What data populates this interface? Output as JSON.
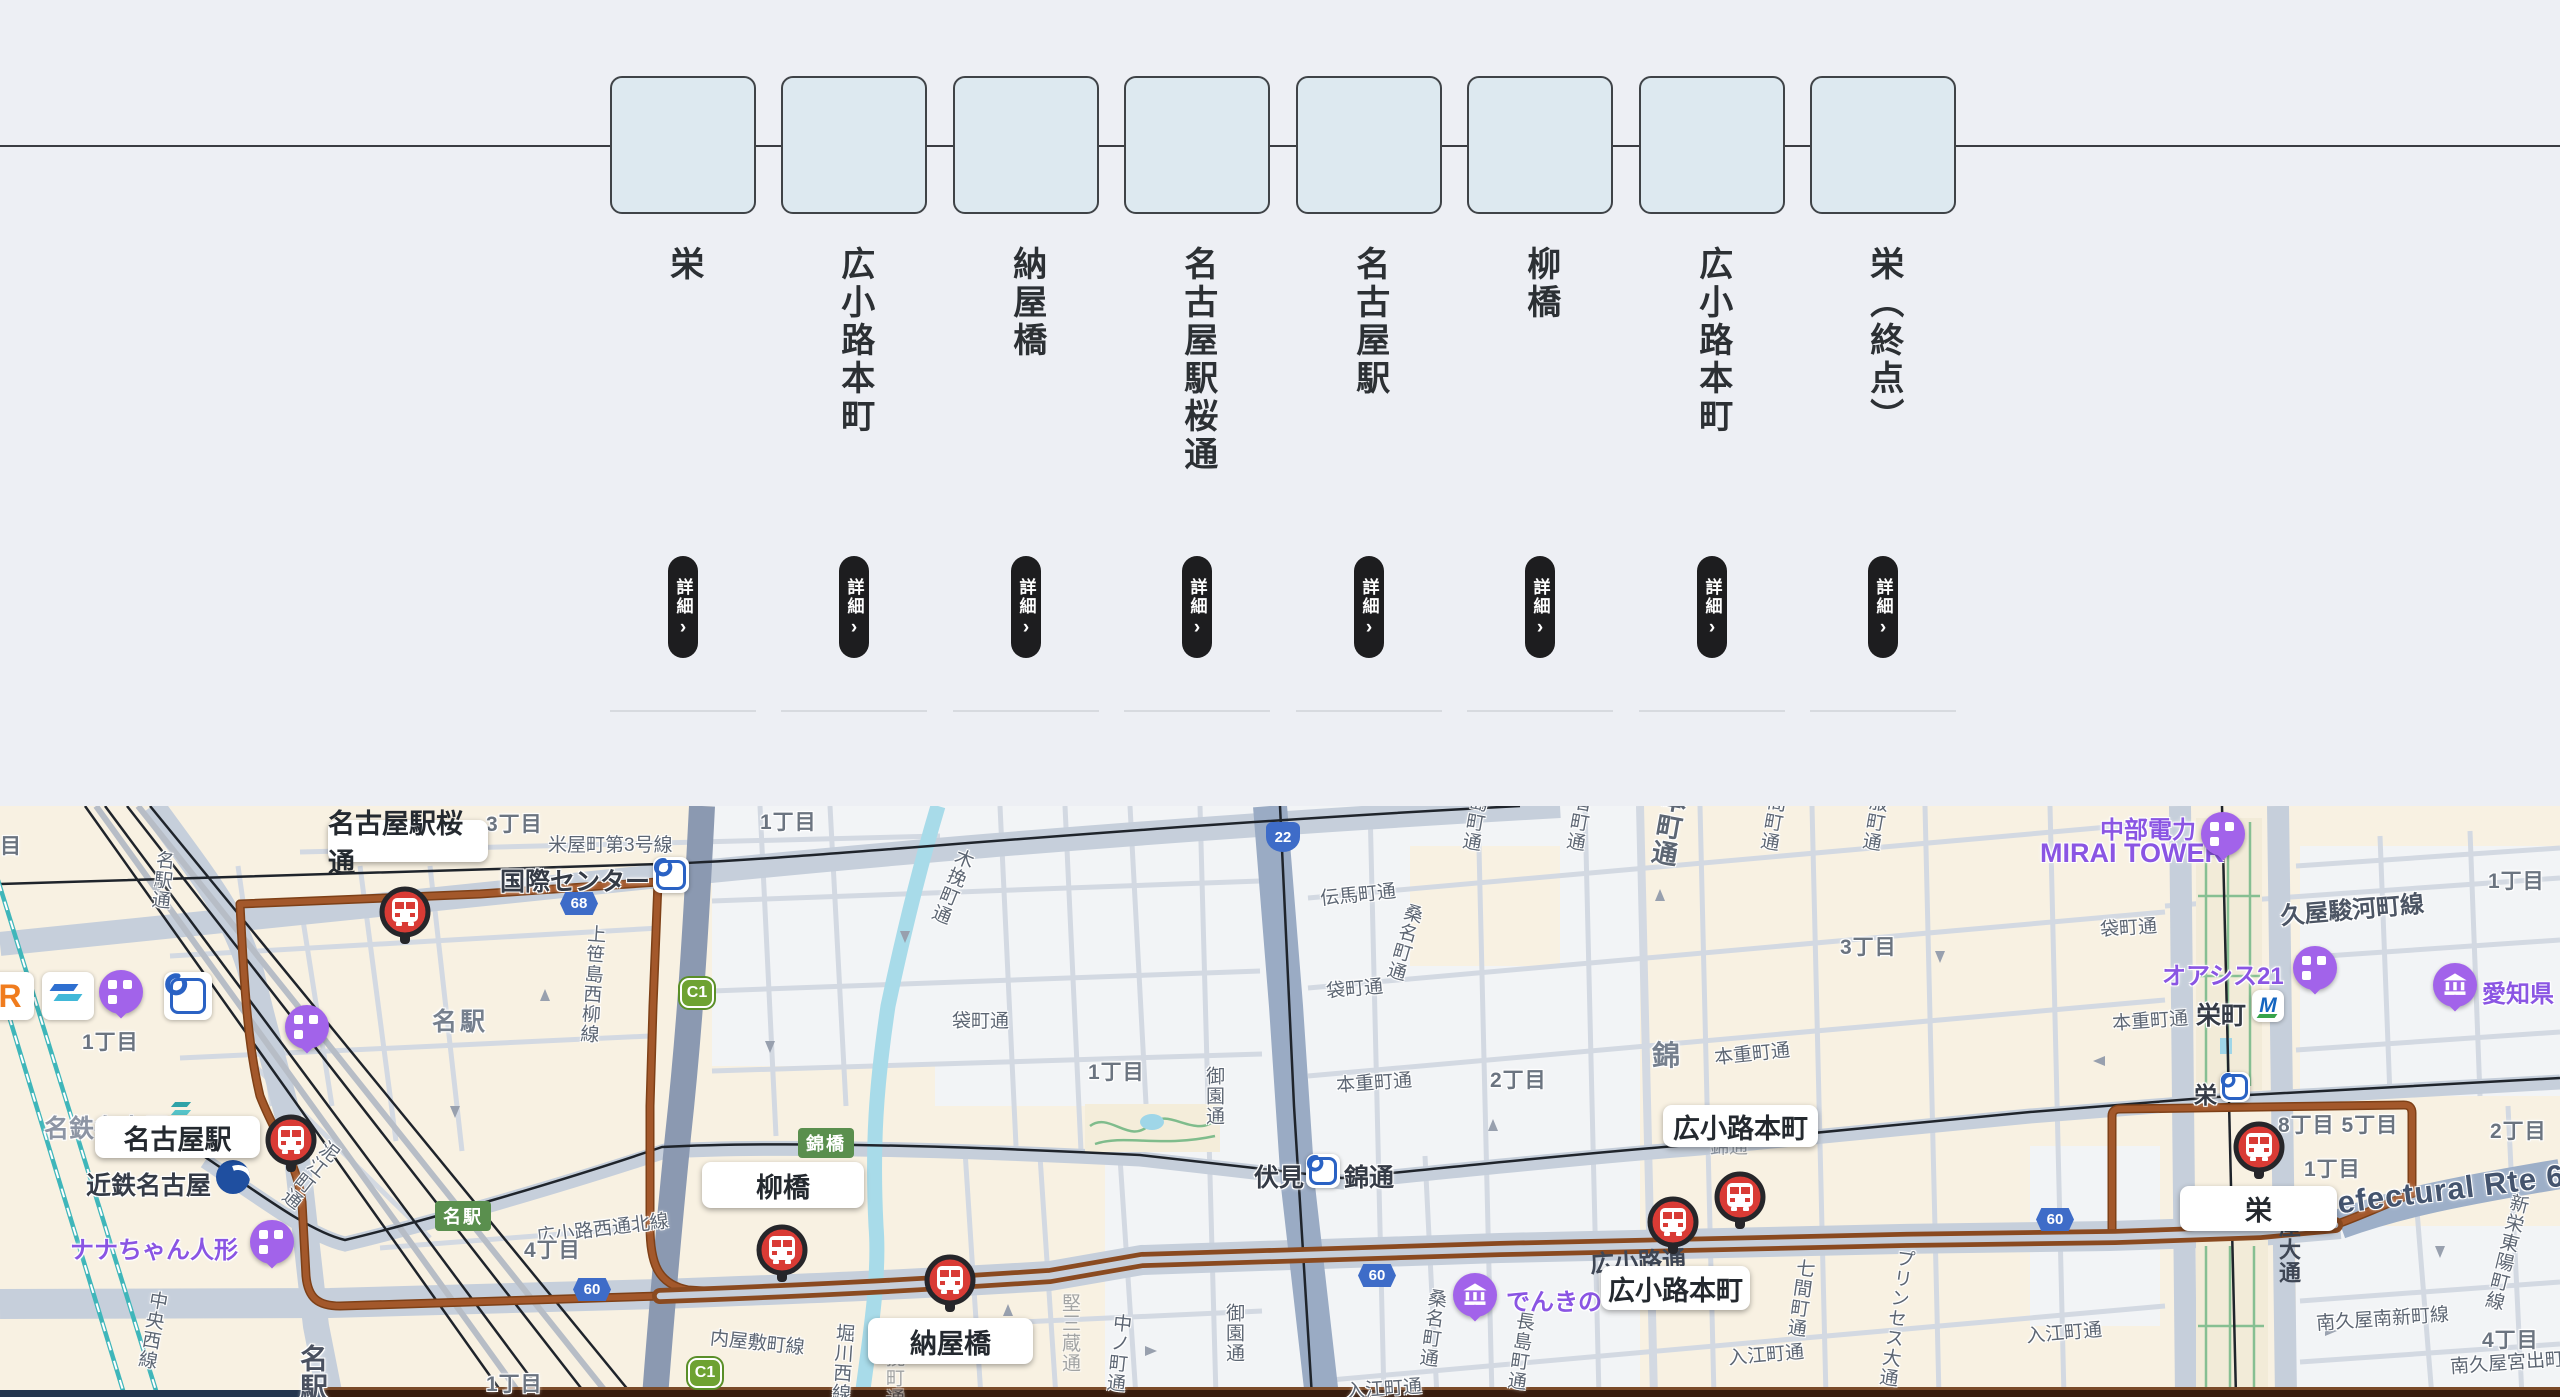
{
  "route_bar": {
    "stations": [
      {
        "name": "栄"
      },
      {
        "name": "広小路本町"
      },
      {
        "name": "納屋橋"
      },
      {
        "name": "名古屋駅桜通"
      },
      {
        "name": "名古屋駅"
      },
      {
        "name": "柳橋"
      },
      {
        "name": "広小路本町"
      },
      {
        "name": "栄（終点）"
      }
    ],
    "detail_label": "詳細",
    "detail_chevron": "›"
  },
  "map": {
    "stop_boxes": [
      "名古屋駅桜通",
      "名古屋駅",
      "柳橋",
      "納屋橋",
      "広小路本町",
      "広小路本町",
      "栄"
    ],
    "stations": {
      "kokusai": "国際センター",
      "fushimi": "伏見",
      "nishikidori": "錦通",
      "sakaemachi": "栄町",
      "sakae": "栄",
      "meitetsu_nagoya": "名鉄名古屋",
      "kintetsu_nagoya": "近鉄名古屋"
    },
    "pois": {
      "nana": "ナナちゃん人形",
      "denki": "でんきの",
      "chubu1": "中部電力",
      "chubu2": "MIRAI TOWER",
      "oasis": "オアシス21",
      "aichi": "愛知県"
    },
    "shields": {
      "c1": "C1",
      "r68": "68",
      "r22": "22",
      "r60": "60",
      "nishikibashi": "錦橋",
      "meieki": "名駅"
    },
    "logos": {
      "jr": "R",
      "meitetsu_m": "M"
    },
    "roads": [
      "米屋町第3号線",
      "名駅通",
      "上笹島西柳線",
      "木挽町通",
      "袋町通",
      "袋町通",
      "伝馬町通",
      "桑名町通",
      "本重町通",
      "御園通",
      "御園通",
      "中ノ町通",
      "内屋敷町線",
      "堀川西線",
      "広小路西通北線",
      "泥江町通",
      "中央西線",
      "名駅通",
      "本重町通",
      "袋町通",
      "本重町通",
      "久屋駿河町線",
      "長島町通",
      "長者町通",
      "本町通",
      "七間町通",
      "呉服町通",
      "長島町通",
      "七間町通",
      "プリンセス大通",
      "入江町通",
      "入江町通",
      "入江町通",
      "桑名町通",
      "堅三蔵通",
      "木挽町通",
      "広小路通",
      "久屋大通",
      "Aichi Prefectural Rte 60",
      "南久屋南新町線",
      "新栄東陽町線",
      "南久屋宮出町",
      "錦通"
    ],
    "areas": [
      "名駅",
      "錦",
      "3丁目",
      "1丁目",
      "1丁目",
      "4丁目",
      "1丁目",
      "2丁目",
      "3丁目",
      "1丁目",
      "8丁目 5丁目",
      "1丁目",
      "2丁目",
      "4丁目",
      "1丁目",
      "目"
    ],
    "colors": {
      "route_brown": "#a3582b",
      "bus_red": "#d93b35",
      "poi_purple": "#a263ea",
      "land": "#f8f1e2",
      "water": "#a8dbe9"
    },
    "icons": {
      "bus_stop": "bus-front-in-red-circle",
      "poi_pin": "purple-station-pin",
      "museum_pin": "purple-museum-pin",
      "subway_logo": "nagoya-subway-mark",
      "kintetsu_logo": "kintetsu-circle",
      "meitetsu_logo": "meitetsu-m",
      "jr_logo": "jr-orange-r",
      "aonami_logo": "blue-waves"
    }
  }
}
